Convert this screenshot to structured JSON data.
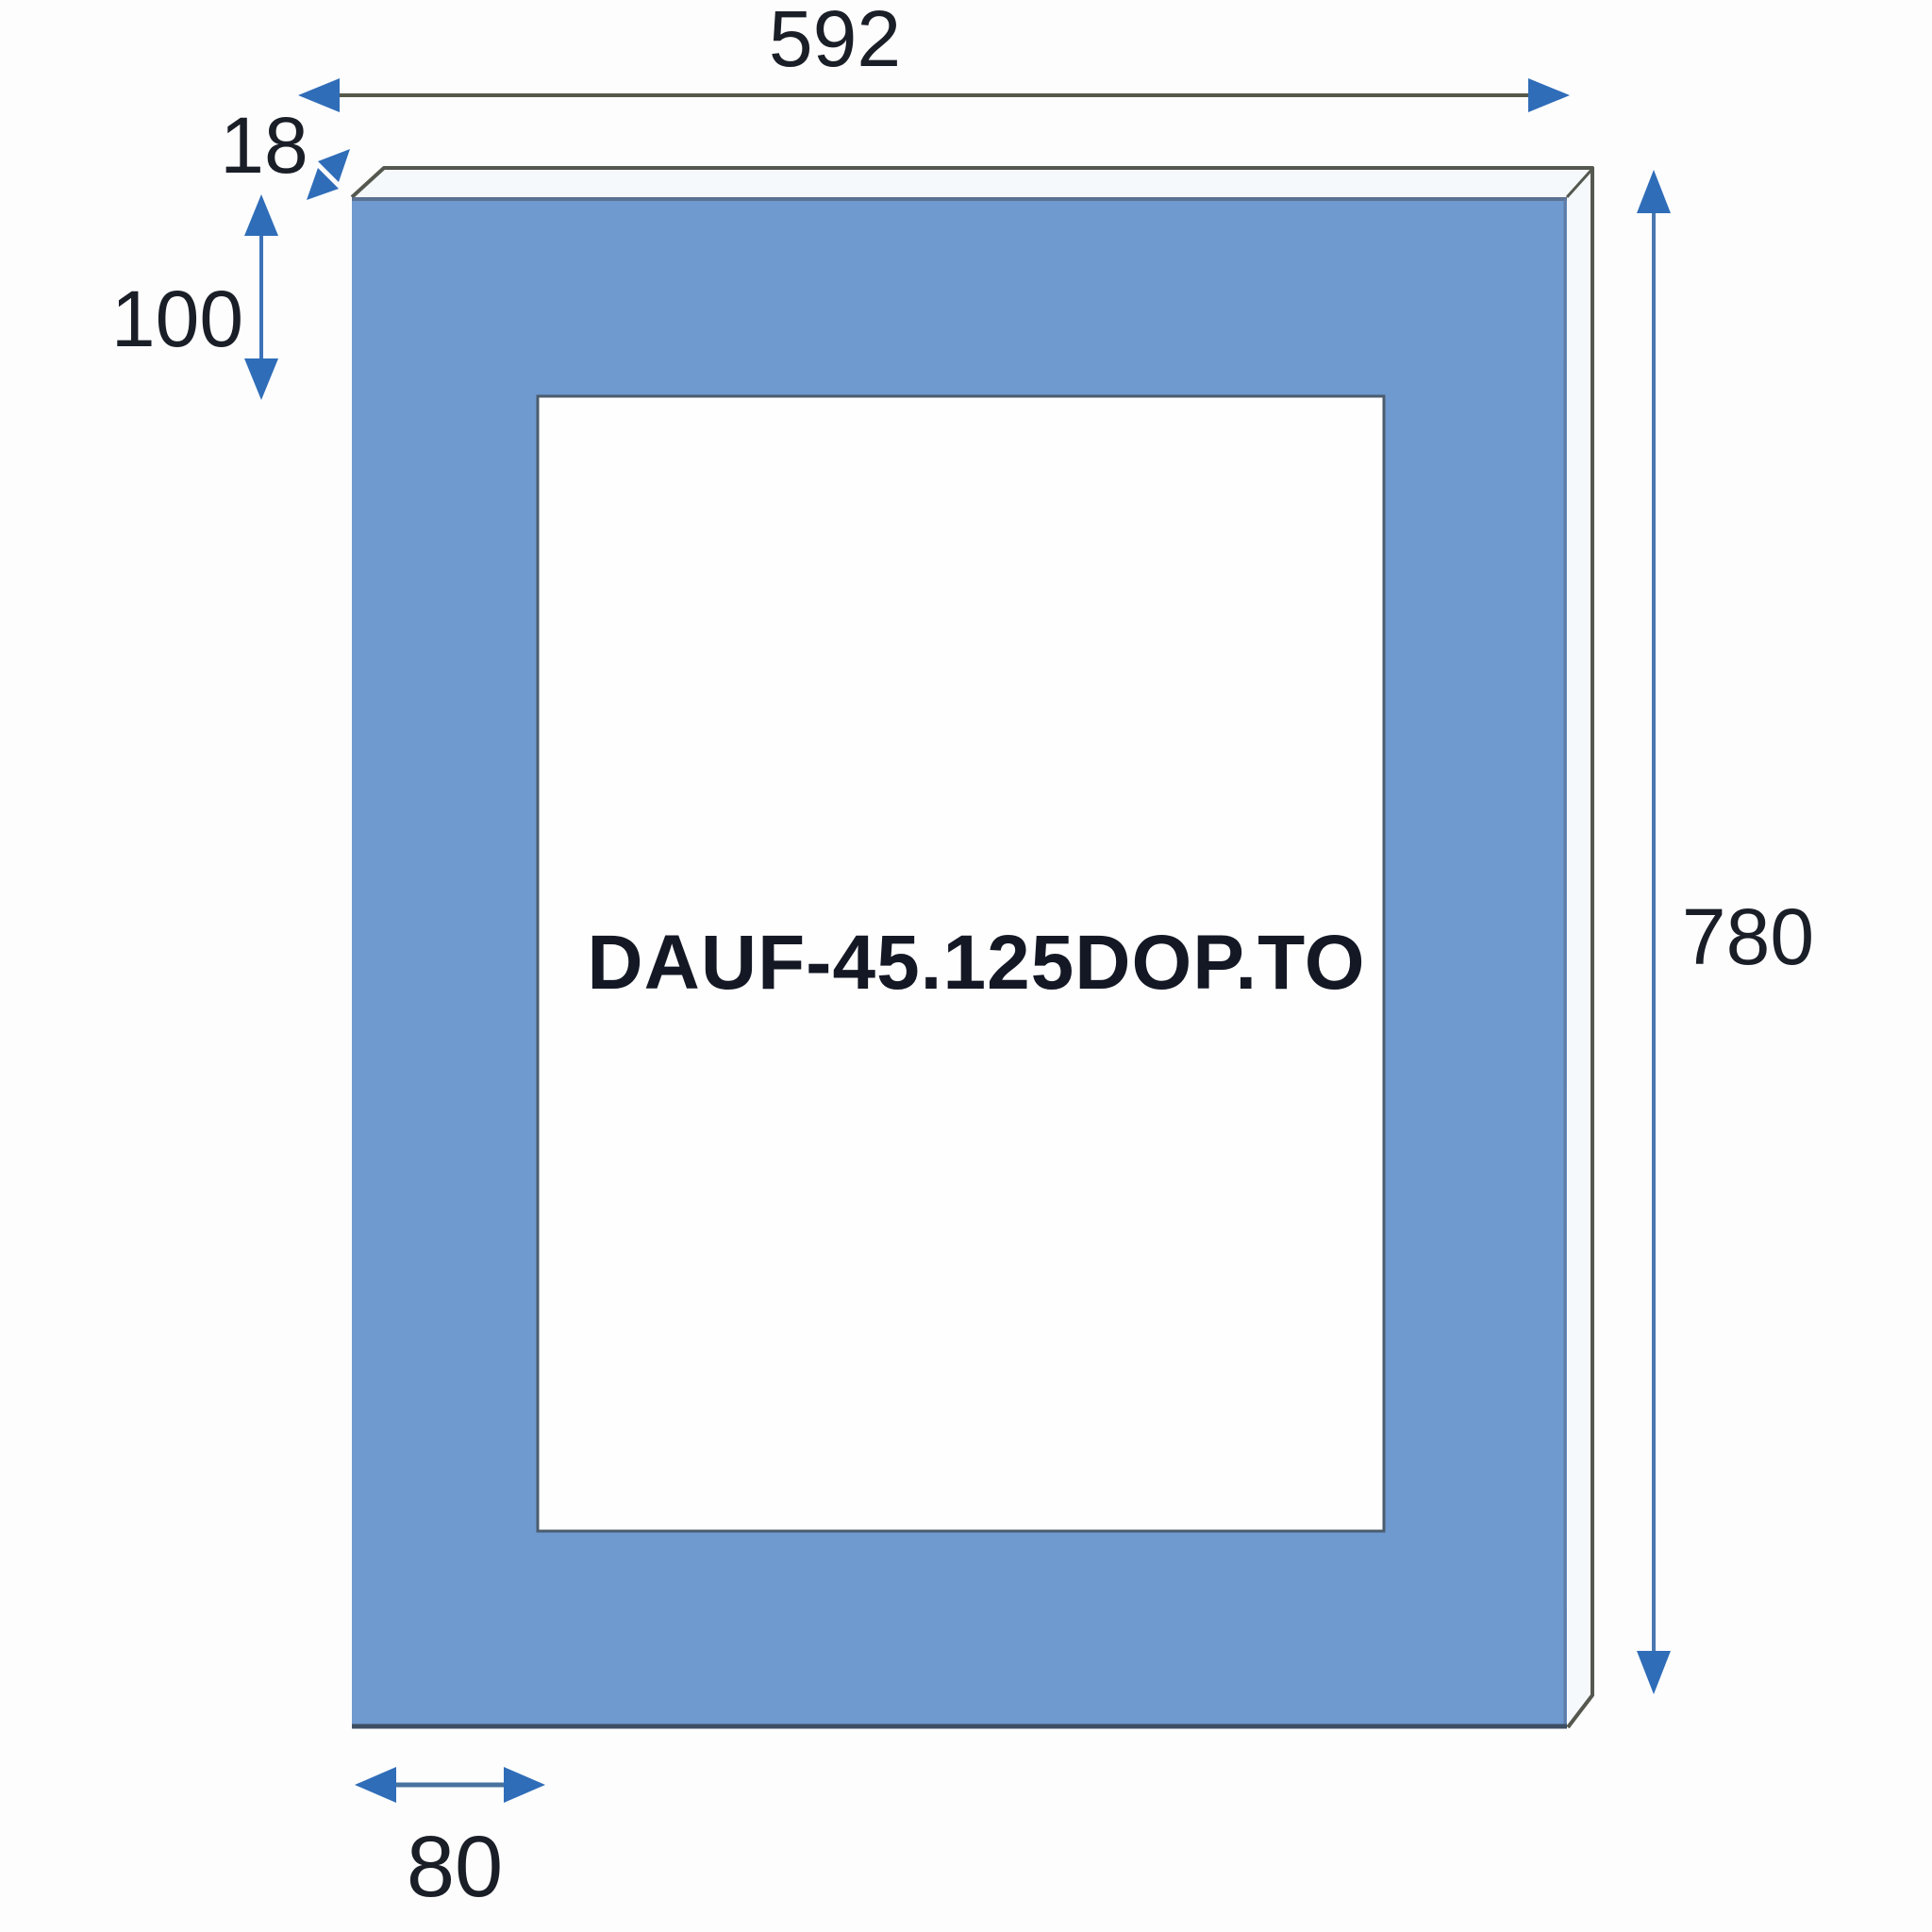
{
  "part_label": "DAUF-45.125DOP.TO",
  "dimensions": {
    "overall_width": "592",
    "edge_thickness": "18",
    "top_rail_height": "100",
    "overall_height": "780",
    "left_stile_width": "80"
  },
  "colors": {
    "panel_face": "#6f9ad0",
    "edge_face": "#f6f9fc",
    "outline_dark": "#55584e",
    "front_top_edge": "#5b7191",
    "front_bottom_edge": "#3c4e63",
    "front_right_edge": "#5e7ca6",
    "cutout_fill": "#fefeff",
    "cutout_border": "#4b5c6e",
    "arrow": "#2f6db8",
    "dim_line_gray": "#56584a",
    "dim_line_blue": "#3c72b8",
    "dim_line_steel": "#4a78b0",
    "dim_line_slate": "#48729f",
    "label_text": "#1a1e27"
  }
}
